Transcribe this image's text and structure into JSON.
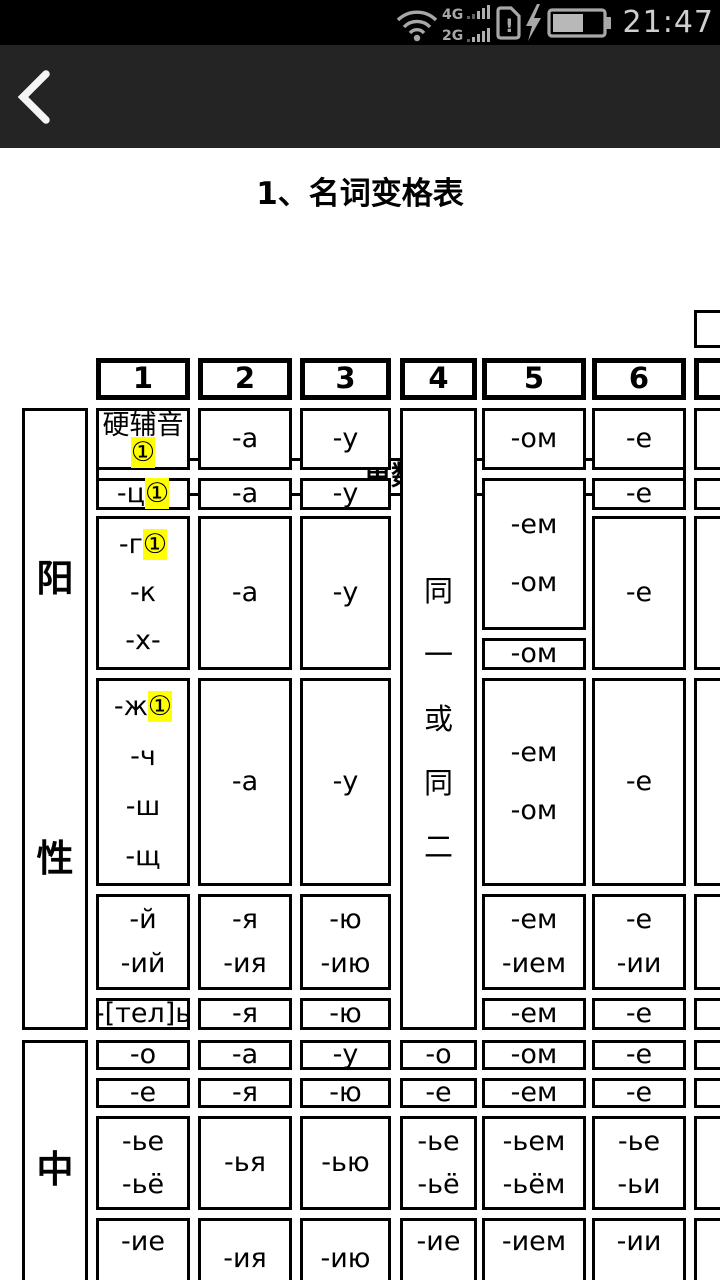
{
  "status_bar": {
    "time": "21:47",
    "net_primary": "4G",
    "net_secondary": "2G",
    "sim_alert_char": "!",
    "battery_level_percent": 60,
    "icons": {
      "wifi": "wifi-icon",
      "signal_bars": "signal-bars-icon",
      "sim": "sim-alert-icon",
      "bolt": "charging-bolt-icon",
      "battery": "battery-icon"
    }
  },
  "app_bar": {
    "back_icon": "back-chevron-icon"
  },
  "page": {
    "title": "1、名词变格表"
  },
  "table": {
    "corner": {
      "top": "数",
      "bottom": "性 格"
    },
    "singular_header": "单数",
    "case_numbers": [
      "1",
      "2",
      "3",
      "4",
      "5",
      "6"
    ],
    "cells": [
      {
        "c": "c1",
        "r": "r1",
        "lines": [
          "硬辅音",
          "①"
        ]
      },
      {
        "c": "c2",
        "r": "r1",
        "lines": [
          "-а"
        ]
      },
      {
        "c": "c3",
        "r": "r1",
        "lines": [
          "-у"
        ]
      },
      {
        "c": "c5",
        "r": "r1",
        "lines": [
          "-ом"
        ]
      },
      {
        "c": "c6",
        "r": "r1",
        "lines": [
          "-е"
        ]
      },
      {
        "c": "c1",
        "r": "r2",
        "lines": [
          "-ц①"
        ]
      },
      {
        "c": "c2",
        "r": "r2",
        "lines": [
          "-а"
        ]
      },
      {
        "c": "c3",
        "r": "r2",
        "lines": [
          "-у"
        ]
      },
      {
        "c": "c6",
        "r": "r2",
        "lines": [
          "-е"
        ]
      },
      {
        "c": "c1",
        "r": "r3",
        "lines": [
          "-г①",
          "-к",
          "-х-"
        ]
      },
      {
        "c": "c2",
        "r": "r3",
        "lines": [
          "-а"
        ]
      },
      {
        "c": "c3",
        "r": "r3",
        "lines": [
          "-у"
        ]
      },
      {
        "c": "c5",
        "r": "s1",
        "lines": [
          "-ем",
          "-ом"
        ]
      },
      {
        "c": "c5",
        "r": "s2",
        "lines": [
          "-ом"
        ]
      },
      {
        "c": "c6",
        "r": "r3",
        "lines": [
          "-е"
        ]
      },
      {
        "c": "c1",
        "r": "r4",
        "lines": [
          "-ж①",
          "-ч",
          "-ш",
          "-щ"
        ]
      },
      {
        "c": "c2",
        "r": "r4",
        "lines": [
          "-а"
        ]
      },
      {
        "c": "c3",
        "r": "r4",
        "lines": [
          "-у"
        ]
      },
      {
        "c": "c5",
        "r": "r4",
        "lines": [
          "-ем",
          "-ом"
        ]
      },
      {
        "c": "c6",
        "r": "r4",
        "lines": [
          "-е"
        ]
      },
      {
        "c": "c1",
        "r": "r5",
        "lines": [
          "-й",
          "-ий"
        ]
      },
      {
        "c": "c2",
        "r": "r5",
        "lines": [
          "-я",
          "-ия"
        ]
      },
      {
        "c": "c3",
        "r": "r5",
        "lines": [
          "-ю",
          "-ию"
        ]
      },
      {
        "c": "c5",
        "r": "r5",
        "lines": [
          "-ем",
          "-ием"
        ]
      },
      {
        "c": "c6",
        "r": "r5",
        "lines": [
          "-е",
          "-ии"
        ]
      },
      {
        "c": "c1",
        "r": "r6",
        "lines": [
          "-[тел]ь"
        ]
      },
      {
        "c": "c2",
        "r": "r6",
        "lines": [
          "-я"
        ]
      },
      {
        "c": "c3",
        "r": "r6",
        "lines": [
          "-ю"
        ]
      },
      {
        "c": "c5",
        "r": "r6",
        "lines": [
          "-ем"
        ]
      },
      {
        "c": "c6",
        "r": "r6",
        "lines": [
          "-е"
        ]
      },
      {
        "c": "c1",
        "r": "r7",
        "lines": [
          "-о"
        ]
      },
      {
        "c": "c2",
        "r": "r7",
        "lines": [
          "-а"
        ]
      },
      {
        "c": "c3",
        "r": "r7",
        "lines": [
          "-у"
        ]
      },
      {
        "c": "c4",
        "r": "r7",
        "lines": [
          "-о"
        ]
      },
      {
        "c": "c5",
        "r": "r7",
        "lines": [
          "-ом"
        ]
      },
      {
        "c": "c6",
        "r": "r7",
        "lines": [
          "-е"
        ]
      },
      {
        "c": "c1",
        "r": "r8",
        "lines": [
          "-е"
        ]
      },
      {
        "c": "c2",
        "r": "r8",
        "lines": [
          "-я"
        ]
      },
      {
        "c": "c3",
        "r": "r8",
        "lines": [
          "-ю"
        ]
      },
      {
        "c": "c4",
        "r": "r8",
        "lines": [
          "-е"
        ]
      },
      {
        "c": "c5",
        "r": "r8",
        "lines": [
          "-ем"
        ]
      },
      {
        "c": "c6",
        "r": "r8",
        "lines": [
          "-е"
        ]
      },
      {
        "c": "c1",
        "r": "r9",
        "lines": [
          "-ье",
          "-ьё"
        ]
      },
      {
        "c": "c2",
        "r": "r9",
        "lines": [
          "-ья"
        ]
      },
      {
        "c": "c3",
        "r": "r9",
        "lines": [
          "-ью"
        ]
      },
      {
        "c": "c4",
        "r": "r9",
        "lines": [
          "-ье",
          "-ьё"
        ]
      },
      {
        "c": "c5",
        "r": "r9",
        "lines": [
          "-ьем",
          "-ьём"
        ]
      },
      {
        "c": "c6",
        "r": "r9",
        "lines": [
          "-ье",
          "-ьи"
        ]
      },
      {
        "c": "c1",
        "r": "r10",
        "lines": [
          "-ие"
        ]
      },
      {
        "c": "c2",
        "r": "r10",
        "lines": [
          "-ия"
        ]
      },
      {
        "c": "c3",
        "r": "r10",
        "lines": [
          "-ию"
        ]
      },
      {
        "c": "c4",
        "r": "r10",
        "lines": [
          "-ие"
        ]
      },
      {
        "c": "c5",
        "r": "r10",
        "lines": [
          "-ием"
        ]
      },
      {
        "c": "c6",
        "r": "r10",
        "lines": [
          "-ии"
        ]
      },
      {
        "c": "head",
        "r": "masc",
        "lines": [
          "阳",
          "性"
        ],
        "kind": "gender"
      },
      {
        "c": "head",
        "r": "neut",
        "lines": [
          "中"
        ],
        "kind": "gender"
      },
      {
        "c": "c4",
        "r": "masc",
        "lines": [
          "同",
          "一",
          "或",
          "同",
          "二"
        ],
        "kind": "note"
      },
      {
        "c": "c7",
        "r": "h1"
      },
      {
        "c": "c7",
        "r": "h2",
        "kind": "num"
      },
      {
        "c": "c7",
        "r": "r1"
      },
      {
        "c": "c7",
        "r": "r2"
      },
      {
        "c": "c7",
        "r": "r3"
      },
      {
        "c": "c7",
        "r": "r4"
      },
      {
        "c": "c7",
        "r": "r5"
      },
      {
        "c": "c7",
        "r": "r6"
      },
      {
        "c": "c7",
        "r": "r7"
      },
      {
        "c": "c7",
        "r": "r8"
      },
      {
        "c": "c7",
        "r": "r9"
      },
      {
        "c": "c7",
        "r": "r10"
      }
    ]
  }
}
